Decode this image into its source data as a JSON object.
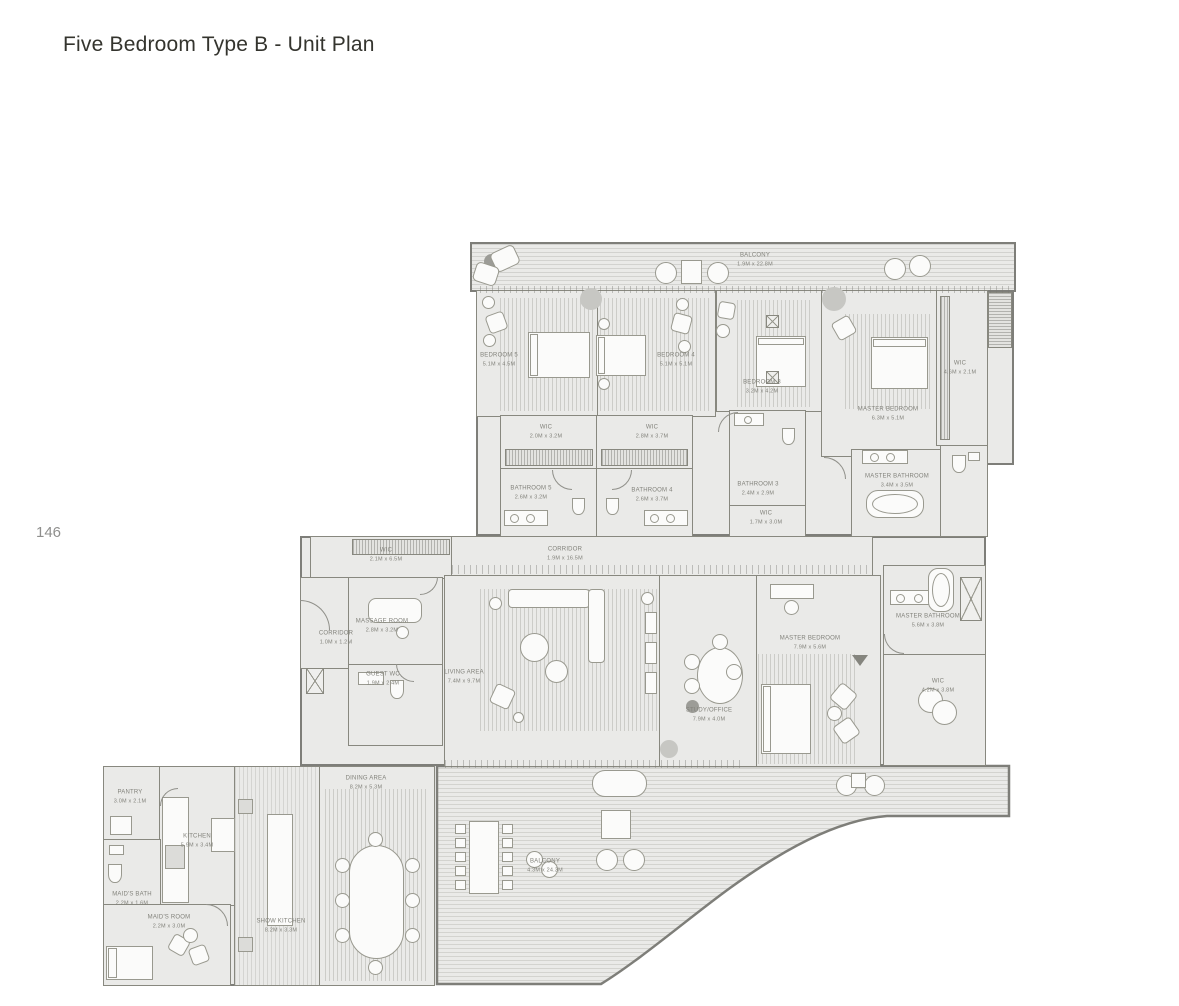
{
  "page": {
    "title": "Five Bedroom Type B - Unit Plan",
    "page_number": "146"
  },
  "colors": {
    "wall": "#7e7e79",
    "room_fill": "#eaeae8",
    "hatch": "#d7d7d4",
    "label_text": "#82827b",
    "title_text": "#34342e",
    "page_num_text": "#8f8f8d",
    "furniture_fill": "#fbfbfa"
  },
  "labels": {
    "balconyTop": {
      "name": "BALCONY",
      "dims": "1.9M x 22.8M"
    },
    "bedroom5": {
      "name": "BEDROOM 5",
      "dims": "5.1M x 4.5M"
    },
    "bedroom4": {
      "name": "BEDROOM 4",
      "dims": "5.1M x 5.1M"
    },
    "bedroom3": {
      "name": "BEDROOM 3",
      "dims": "3.2M x 4.2M"
    },
    "masterBedroomTop": {
      "name": "MASTER BEDROOM",
      "dims": "6.3M x 5.1M"
    },
    "wicRight": {
      "name": "WIC",
      "dims": "4.6M x 2.1M"
    },
    "wicB5": {
      "name": "WIC",
      "dims": "2.0M x 3.2M"
    },
    "wicB4": {
      "name": "WIC",
      "dims": "2.8M x 3.7M"
    },
    "bathroom5": {
      "name": "BATHROOM 5",
      "dims": "2.6M x 3.2M"
    },
    "bathroom4": {
      "name": "BATHROOM 4",
      "dims": "2.6M x 3.7M"
    },
    "bathroom3": {
      "name": "BATHROOM 3",
      "dims": "2.4M x 2.9M"
    },
    "masterBathTop": {
      "name": "MASTER BATHROOM",
      "dims": "3.4M x 3.5M"
    },
    "wicSmall": {
      "name": "WIC",
      "dims": "1.7M x 3.0M"
    },
    "wicMid": {
      "name": "WIC",
      "dims": "2.1M x 6.5M"
    },
    "corridorMain": {
      "name": "CORRIDOR",
      "dims": "1.9M x 16.5M"
    },
    "corridorSmall": {
      "name": "CORRIDOR",
      "dims": "1.0M x 1.2M"
    },
    "massageRoom": {
      "name": "MASSAGE ROOM",
      "dims": "2.8M x 3.2M"
    },
    "guestWc": {
      "name": "GUEST WC",
      "dims": "1.9M x 2.4M"
    },
    "livingArea": {
      "name": "LIVING AREA",
      "dims": "7.4M x 9.7M"
    },
    "study": {
      "name": "STUDY/OFFICE",
      "dims": "7.9M x 4.0M"
    },
    "masterBedroomLow": {
      "name": "MASTER BEDROOM",
      "dims": "7.9M x 5.6M"
    },
    "masterBathLow": {
      "name": "MASTER BATHROOM",
      "dims": "5.6M x 3.8M"
    },
    "wicLow": {
      "name": "WIC",
      "dims": "4.2M x 3.8M"
    },
    "pantry": {
      "name": "PANTRY",
      "dims": "3.0M x 2.1M"
    },
    "kitchen": {
      "name": "KITCHEN",
      "dims": "5.9M x 3.4M"
    },
    "maidsBath": {
      "name": "MAID'S BATH",
      "dims": "2.2M x 1.6M"
    },
    "maidsRoom": {
      "name": "MAID'S ROOM",
      "dims": "2.2M x 3.0M"
    },
    "showKitchen": {
      "name": "SHOW KITCHEN",
      "dims": "8.2M x 3.3M"
    },
    "diningArea": {
      "name": "DINING AREA",
      "dims": "8.2M x 5.3M"
    },
    "balconyBottom": {
      "name": "BALCONY",
      "dims": "4.3M x 24.3M"
    }
  }
}
